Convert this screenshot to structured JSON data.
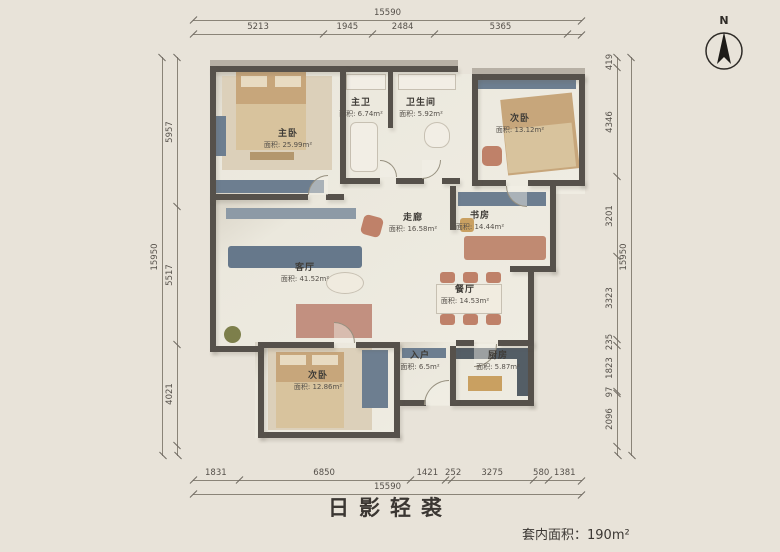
{
  "meta": {
    "title": "日影轻裘",
    "area_note_label": "套内面积：",
    "area_note_value": "190m²",
    "north_label": "N"
  },
  "dimensions": {
    "top": {
      "total": "15590",
      "segments": [
        "5213",
        "1945",
        "2484",
        "5365"
      ]
    },
    "bottom": {
      "total": "15590",
      "segments": [
        "1831",
        "6850",
        "1421",
        "252",
        "3275",
        "580",
        "1381"
      ]
    },
    "left": {
      "total": "15950",
      "segments": [
        "5957",
        "5517",
        "4021"
      ]
    },
    "right": {
      "total": "15950",
      "segments": [
        "419",
        "4346",
        "3201",
        "3323",
        "235",
        "1823",
        "97",
        "2096"
      ]
    }
  },
  "rooms": [
    {
      "name": "主卧",
      "area": "面积: 25.99m²"
    },
    {
      "name": "主卫",
      "area": "面积: 6.74m²"
    },
    {
      "name": "卫生间",
      "area": "面积: 5.92m²"
    },
    {
      "name": "次卧",
      "area": "面积: 13.12m²"
    },
    {
      "name": "书房",
      "area": "面积: 14.44m²"
    },
    {
      "name": "走廊",
      "area": "面积: 16.58m²"
    },
    {
      "name": "客厅",
      "area": "面积: 41.52m²"
    },
    {
      "name": "餐厅",
      "area": "面积: 14.53m²"
    },
    {
      "name": "入户",
      "area": "面积: 6.5m²"
    },
    {
      "name": "厨房",
      "area": "面积: 5.87m²"
    },
    {
      "name": "次卧",
      "area": "面积: 12.86m²"
    }
  ],
  "colors": {
    "background": "#e8e3d9",
    "wall": "#56514b",
    "wall_top": "#b7b0a5",
    "floor": "#edeadf",
    "furniture_slate": "#6d7e90",
    "furniture_wood": "#c7a67b",
    "furniture_terracotta": "#bf8169",
    "fixture_white": "#f2eee5",
    "dimension_text": "#55504a"
  }
}
